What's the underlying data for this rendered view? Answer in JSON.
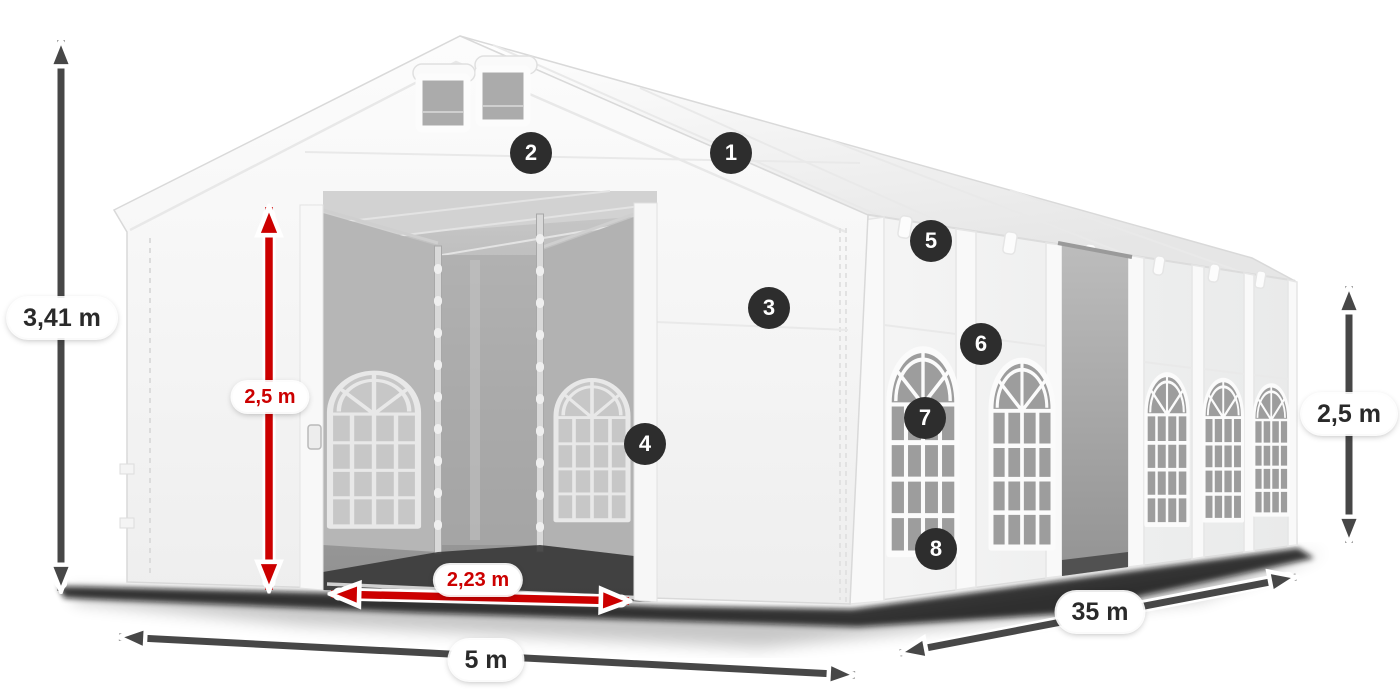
{
  "theme": {
    "accent_red": "#cc0000",
    "arrow_gray": "#474747",
    "badge_bg": "#2d2d2d",
    "pill_bg": "#ffffff",
    "label_dark": "#2a2a2a"
  },
  "diagram": {
    "type": "product-dimension-diagram",
    "subject": "white storage/party tent with front sliding doors and arched side windows",
    "dimensions": {
      "total_height": {
        "label": "3,41 m",
        "style": "gray",
        "orientation": "vertical",
        "position": "far-left"
      },
      "door_height": {
        "label": "2,5 m",
        "style": "red",
        "orientation": "vertical",
        "position": "front-left-panel"
      },
      "door_width": {
        "label": "2,23 m",
        "style": "red",
        "orientation": "horizontal",
        "position": "front-door-sill"
      },
      "front_width": {
        "label": "5 m",
        "style": "gray",
        "orientation": "horizontal",
        "position": "below-front"
      },
      "side_length": {
        "label": "35 m",
        "style": "gray",
        "orientation": "diagonal",
        "position": "below-side"
      },
      "side_height": {
        "label": "2,5 m",
        "style": "gray",
        "orientation": "vertical",
        "position": "far-right"
      }
    },
    "markers": [
      {
        "number": "1"
      },
      {
        "number": "2"
      },
      {
        "number": "3"
      },
      {
        "number": "4"
      },
      {
        "number": "5"
      },
      {
        "number": "6"
      },
      {
        "number": "7"
      },
      {
        "number": "8"
      }
    ]
  }
}
